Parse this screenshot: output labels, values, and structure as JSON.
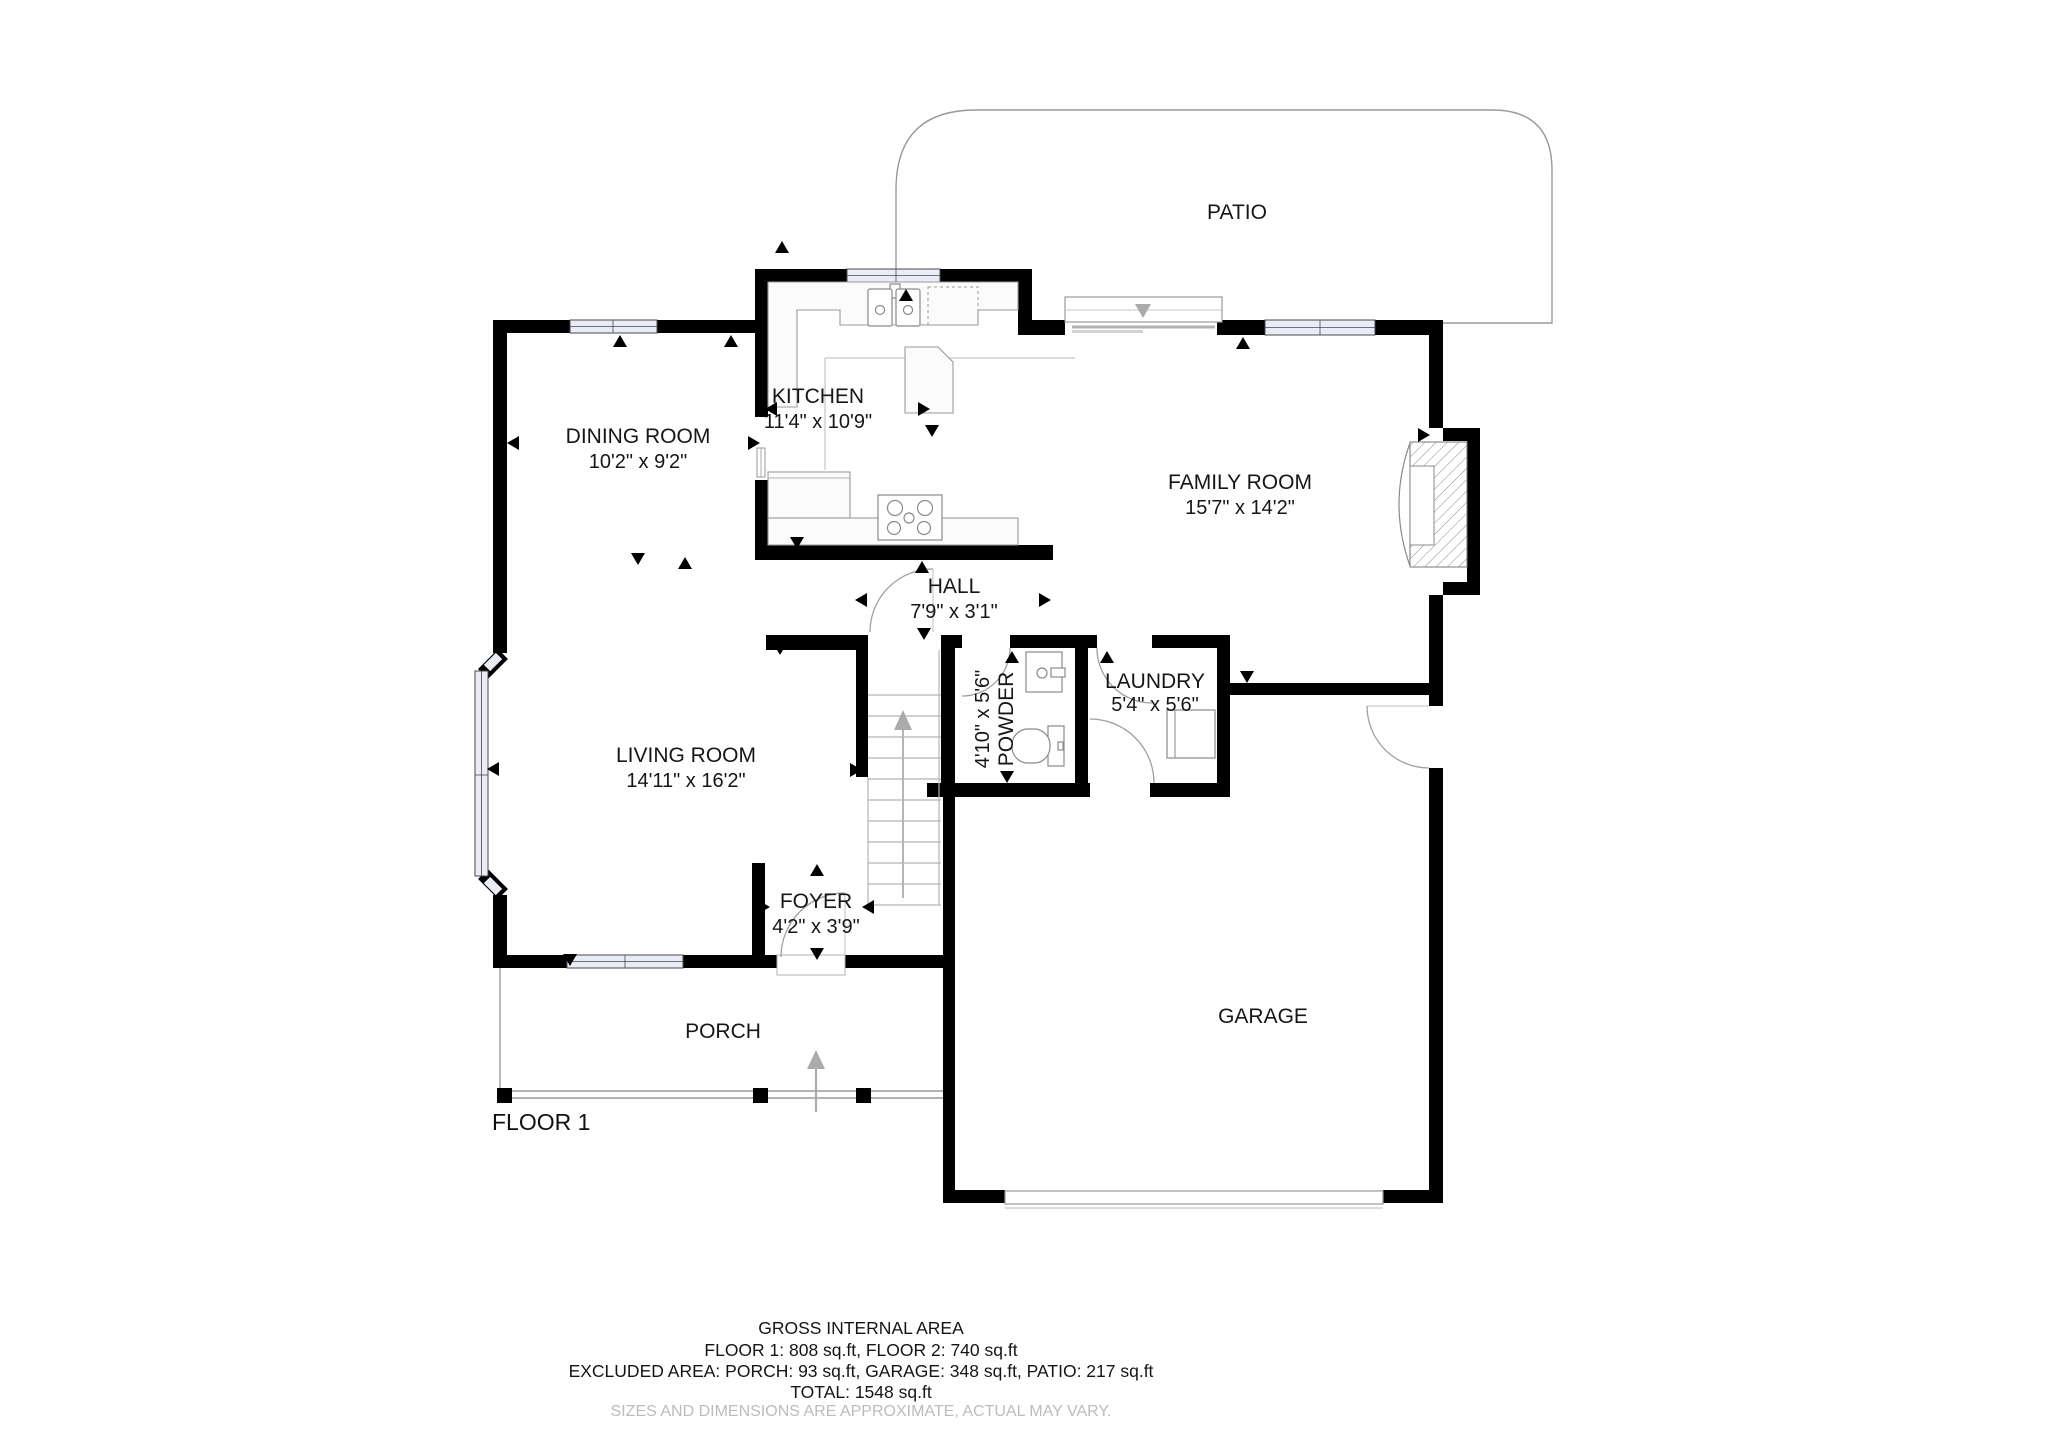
{
  "plan": {
    "floor_label": "FLOOR 1",
    "rooms": [
      {
        "id": "patio",
        "name": "PATIO",
        "dims": ""
      },
      {
        "id": "kitchen",
        "name": "KITCHEN",
        "dims": "11'4\" x 10'9\""
      },
      {
        "id": "dining",
        "name": "DINING ROOM",
        "dims": "10'2\" x 9'2\""
      },
      {
        "id": "family",
        "name": "FAMILY ROOM",
        "dims": "15'7\" x 14'2\""
      },
      {
        "id": "hall",
        "name": "HALL",
        "dims": "7'9\" x 3'1\""
      },
      {
        "id": "powder",
        "name": "POWDER",
        "dims": "4'10\" x 5'6\""
      },
      {
        "id": "laundry",
        "name": "LAUNDRY",
        "dims": "5'4\" x 5'6\""
      },
      {
        "id": "living",
        "name": "LIVING ROOM",
        "dims": "14'11\" x 16'2\""
      },
      {
        "id": "foyer",
        "name": "FOYER",
        "dims": "4'2\" x 3'9\""
      },
      {
        "id": "garage",
        "name": "GARAGE",
        "dims": ""
      },
      {
        "id": "porch",
        "name": "PORCH",
        "dims": ""
      }
    ],
    "footer": {
      "title": "GROSS INTERNAL AREA",
      "line1": "FLOOR 1: 808 sq.ft, FLOOR 2: 740 sq.ft",
      "line2": "EXCLUDED AREA: PORCH: 93 sq.ft, GARAGE: 348 sq.ft, PATIO: 217 sq.ft",
      "line3": "TOTAL: 1548 sq.ft",
      "disclaimer": "SIZES AND DIMENSIONS ARE APPROXIMATE, ACTUAL MAY VARY."
    }
  }
}
